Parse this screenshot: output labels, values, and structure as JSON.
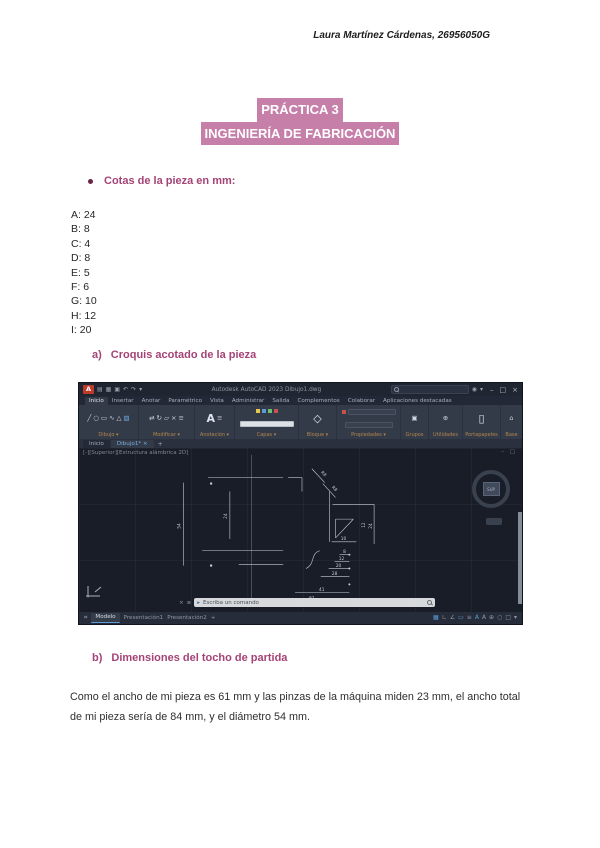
{
  "doc": {
    "header": "Laura Martínez Cárdenas, 26956050G",
    "title": {
      "line1": "PRÁCTICA 3",
      "line2": "INGENIERÍA DE FABRICACIÓN"
    },
    "bullet": "Cotas de la pieza en mm:",
    "cotas": [
      "A: 24",
      "B: 8",
      "C: 4",
      "D: 8",
      "E: 5",
      "F: 6",
      "G: 10",
      "H: 12",
      "I: 20"
    ],
    "section_a": {
      "letter": "a)",
      "text": "Croquis acotado de la pieza"
    },
    "section_b": {
      "letter": "b)",
      "text": "Dimensiones del tocho de partida"
    },
    "paragraph": "Como el ancho de mi pieza es 61 mm  y las pinzas de la máquina miden 23 mm, el ancho total de mi pieza sería de 84 mm, y el diámetro 54 mm.",
    "colors": {
      "highlight": "#c67fa9",
      "heading": "#a54376"
    }
  },
  "autocad": {
    "window_title": "Autodesk AutoCAD 2023   Dibujo1.dwg",
    "ribbon_tabs": [
      "Inicio",
      "Insertar",
      "Anotar",
      "Paramétrico",
      "Vista",
      "Administrar",
      "Salida",
      "Complementos",
      "Colaborar",
      "Aplicaciones destacadas"
    ],
    "panels": [
      "Dibujo",
      "Modificar",
      "Anotación",
      "Capas",
      "Bloque",
      "Propiedades",
      "Grupos",
      "Utilidades",
      "Portapapeles",
      "Base"
    ],
    "file_tabs": {
      "start": "Inicio",
      "drawing": "Dibujo1*",
      "close": "×",
      "new": "+"
    },
    "viewport_label": "[-][Superior][Estructura alámbrica 2D]",
    "viewcube_label": "SUP",
    "command_prompt": "Escriba un comando",
    "layout_tabs": {
      "model": "Modelo",
      "layout1": "Presentación1",
      "layout2": "Presentación2",
      "new": "+"
    },
    "drawing_dims": {
      "d0": "54",
      "d1": "24",
      "d2": "R8",
      "d3": "R8",
      "d4": "24",
      "d5": "12",
      "d6": "10",
      "d7": "8",
      "d8": "12",
      "d9": "20",
      "d10": "28",
      "d11": "41",
      "d12": "61"
    }
  }
}
